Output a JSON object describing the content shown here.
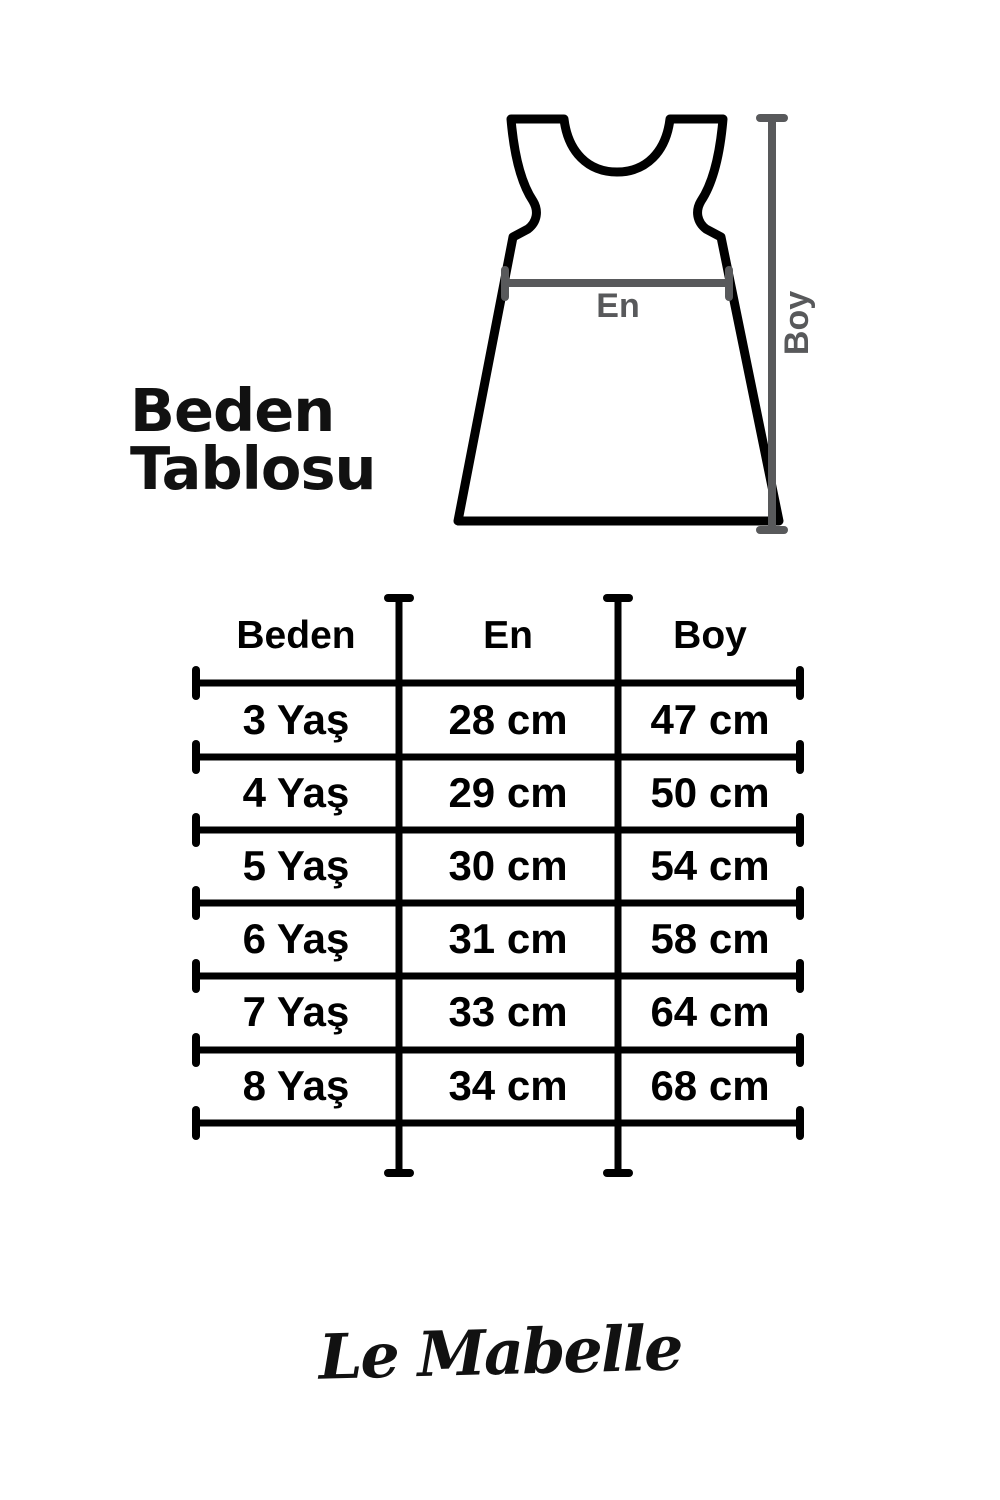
{
  "title": "Beden Tablosu",
  "diagram": {
    "width_label": "En",
    "height_label": "Boy"
  },
  "table": {
    "headers": [
      "Beden",
      "En",
      "Boy"
    ],
    "rows": [
      {
        "size": "3 Yaş",
        "en": "28 cm",
        "boy": "47 cm"
      },
      {
        "size": "4 Yaş",
        "en": "29 cm",
        "boy": "50 cm"
      },
      {
        "size": "5 Yaş",
        "en": "30 cm",
        "boy": "54 cm"
      },
      {
        "size": "6 Yaş",
        "en": "31 cm",
        "boy": "58 cm"
      },
      {
        "size": "7 Yaş",
        "en": "33 cm",
        "boy": "64 cm"
      },
      {
        "size": "8 Yaş",
        "en": "34 cm",
        "boy": "68 cm"
      }
    ]
  },
  "brand": {
    "logo_text": "Le Mabelle"
  },
  "colors": {
    "ink": "#000000",
    "measure_gray": "#58595B",
    "background": "#FFFFFF"
  }
}
